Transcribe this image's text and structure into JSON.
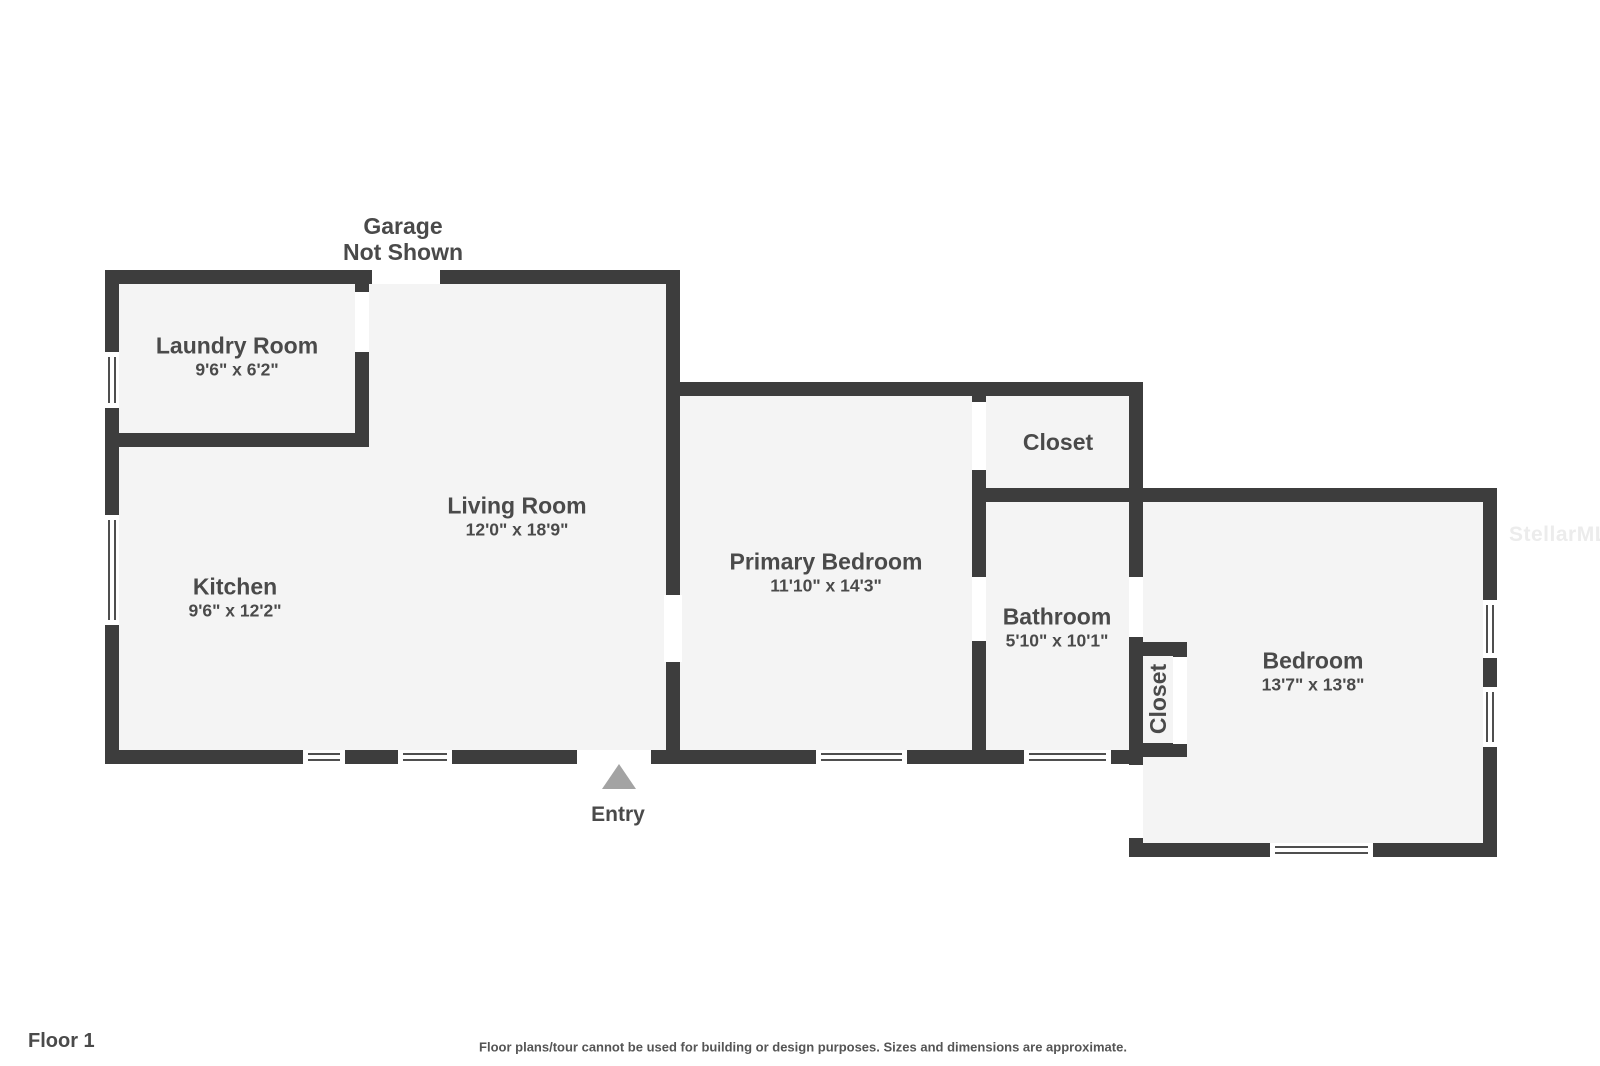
{
  "rooms": [
    {
      "id": "laundry-room",
      "name": "Laundry Room",
      "dims": "9'6\" x 6'2\""
    },
    {
      "id": "kitchen",
      "name": "Kitchen",
      "dims": "9'6\" x 12'2\""
    },
    {
      "id": "living-room",
      "name": "Living Room",
      "dims": "12'0\" x 18'9\""
    },
    {
      "id": "primary-bedroom",
      "name": "Primary Bedroom",
      "dims": "11'10\" x 14'3\""
    },
    {
      "id": "closet",
      "name": "Closet",
      "dims": ""
    },
    {
      "id": "bathroom",
      "name": "Bathroom",
      "dims": "5'10\" x 10'1\""
    },
    {
      "id": "bedroom-closet",
      "name": "Closet",
      "dims": ""
    },
    {
      "id": "bedroom",
      "name": "Bedroom",
      "dims": "13'7\" x 13'8\""
    }
  ],
  "garage_note": {
    "line1": "Garage",
    "line2": "Not Shown"
  },
  "entry": {
    "label": "Entry"
  },
  "footer": {
    "floor_label": "Floor 1",
    "disclaimer": "Floor plans/tour cannot be used for building or design purposes. Sizes and dimensions are approximate."
  },
  "watermark": "StellarMLS",
  "colors": {
    "wall": "#3d3d3d",
    "room_fill": "#f4f4f4",
    "text": "#4a4a4a",
    "entry_arrow": "#a3a3a3",
    "watermark": "#ececec",
    "background": "#ffffff"
  }
}
